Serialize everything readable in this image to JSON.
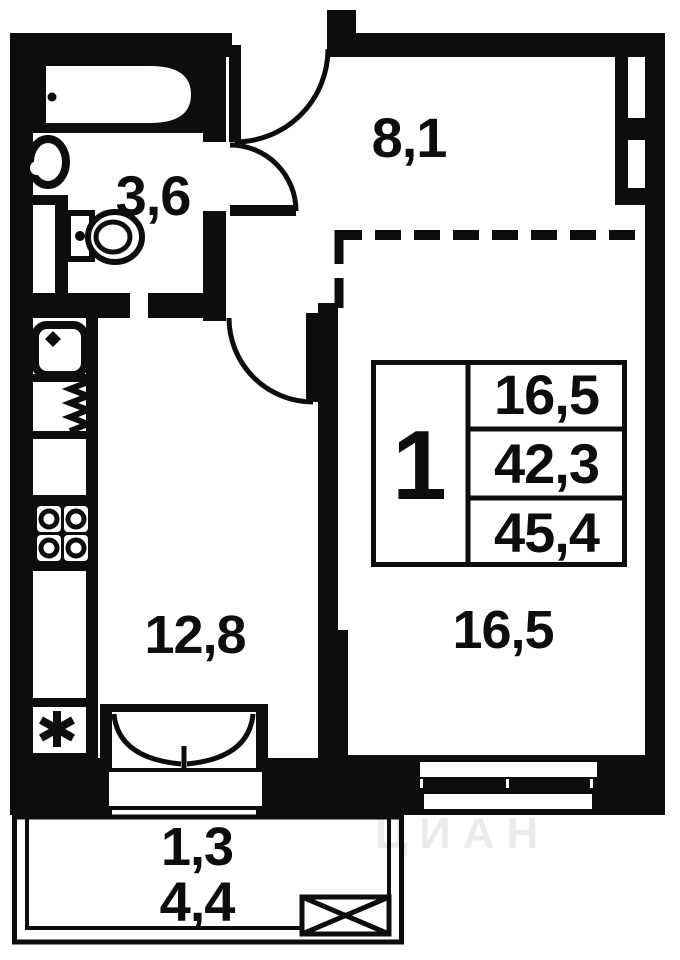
{
  "plan": {
    "type": "apartment-floor-plan",
    "rooms": {
      "bathroom": "3,6",
      "hallway": "8,1",
      "kitchen": "12,8",
      "living_room": "16,5",
      "balcony_reduced": "1,3",
      "balcony": "4,4"
    },
    "info_table": {
      "rooms_count": "1",
      "living_area": "16,5",
      "area_without_balcony": "42,3",
      "total_area": "45,4"
    },
    "watermark": "ЦИАН",
    "colors": {
      "line": "#0d0d0d",
      "background": "#ffffff"
    },
    "icons": {
      "bathtub": "bathtub-icon",
      "washbasin": "washbasin-icon",
      "toilet": "toilet-icon",
      "kitchen_sink": "kitchen-sink-icon",
      "dish_rack": "dish-rack-icon",
      "stove": "stove-icon",
      "closet_marker": "asterisk-icon",
      "balcony_hatch": "balcony-hatch-icon"
    }
  }
}
